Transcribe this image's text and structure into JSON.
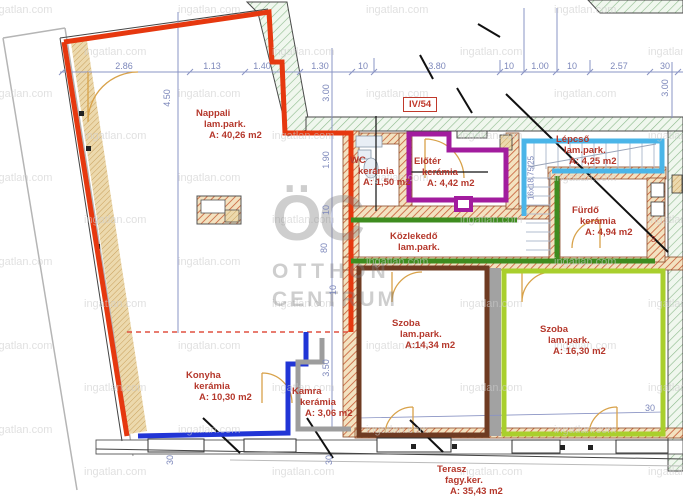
{
  "watermark": {
    "text": "ingatlan.com"
  },
  "logo": {
    "monogram": "ÖC",
    "line1": "OTTHON",
    "line2": "CENTRUM"
  },
  "unit_label": "IV/54",
  "stair_note": "16x18,75/25",
  "misc": {
    "small_three": "3"
  },
  "rooms": [
    {
      "id": "nappali",
      "name": "Nappali",
      "finish": "lam.park.",
      "area": "A: 40,26 m2",
      "outline_color": "#e6380f"
    },
    {
      "id": "wc",
      "name": "WC",
      "finish": "kerámia",
      "area": "A: 1,50 m2",
      "outline_color": "#e6380f"
    },
    {
      "id": "eloter",
      "name": "Előtér",
      "finish": "kerámia",
      "area": "A: 4,42 m2",
      "outline_color": "#a21c9e"
    },
    {
      "id": "lepcso",
      "name": "Lépcső",
      "finish": "lam.park.",
      "area": "A: 4,25 m2",
      "outline_color": "#4ab5e8"
    },
    {
      "id": "furdo",
      "name": "Fürdő",
      "finish": "kerámia",
      "area": "A: 4,94 m2",
      "outline_color": "#3e8c1f"
    },
    {
      "id": "kozlekedo",
      "name": "Közlekedő",
      "finish": "lam.park.",
      "area": "",
      "outline_color": "#3e8c1f"
    },
    {
      "id": "szoba-1",
      "name": "Szoba",
      "finish": "lam.park.",
      "area": "A:14,34 m2",
      "outline_color": "#6f3b22"
    },
    {
      "id": "szoba-2",
      "name": "Szoba",
      "finish": "lam.park.",
      "area": "A: 16,30 m2",
      "outline_color": "#a9cf2d"
    },
    {
      "id": "konyha",
      "name": "Konyha",
      "finish": "kerámia",
      "area": "A: 10,30 m2",
      "outline_color": "#2135d6"
    },
    {
      "id": "kamra",
      "name": "Kamra",
      "finish": "kerámia",
      "area": "A: 3,06 m2",
      "outline_color": "#9d9d9d"
    },
    {
      "id": "terasz",
      "name": "Terasz",
      "finish": "fagy.ker.",
      "area": "A: 35,43 m2",
      "outline_color": ""
    }
  ],
  "dims": {
    "top": [
      "2.86",
      "1.13",
      "1.40",
      "1.30",
      "10",
      "3.80",
      "10",
      "1.00",
      "10",
      "2.57",
      "30"
    ],
    "side": [
      "4.50",
      "3.00",
      "1.90",
      "10",
      "80",
      "10",
      "3.50",
      "30",
      "30",
      "3.00",
      "30"
    ]
  }
}
